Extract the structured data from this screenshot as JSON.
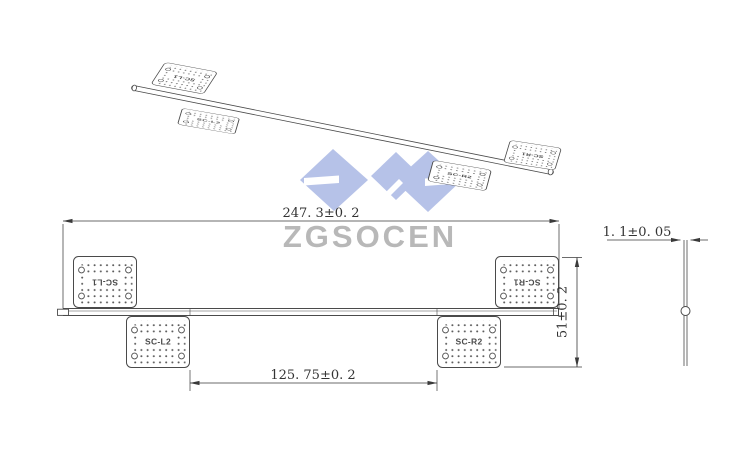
{
  "watermark": {
    "brand": "ZGSOCEN",
    "logo_color": "#b6c2e8",
    "text_color": "#b8b8b8"
  },
  "plates": {
    "l1": "SC-L1",
    "l2": "SC-L2",
    "r1": "SC-R1",
    "r2": "SC-R2"
  },
  "front_view": {
    "dim_overall_width": "247. 3±0. 2",
    "dim_inner_width": "125. 75±0. 2",
    "dim_height": "51±0. 2"
  },
  "side_view": {
    "dim_thickness": "1. 1±0. 05"
  },
  "style": {
    "line_color": "#4a4a4a",
    "background": "#ffffff"
  }
}
